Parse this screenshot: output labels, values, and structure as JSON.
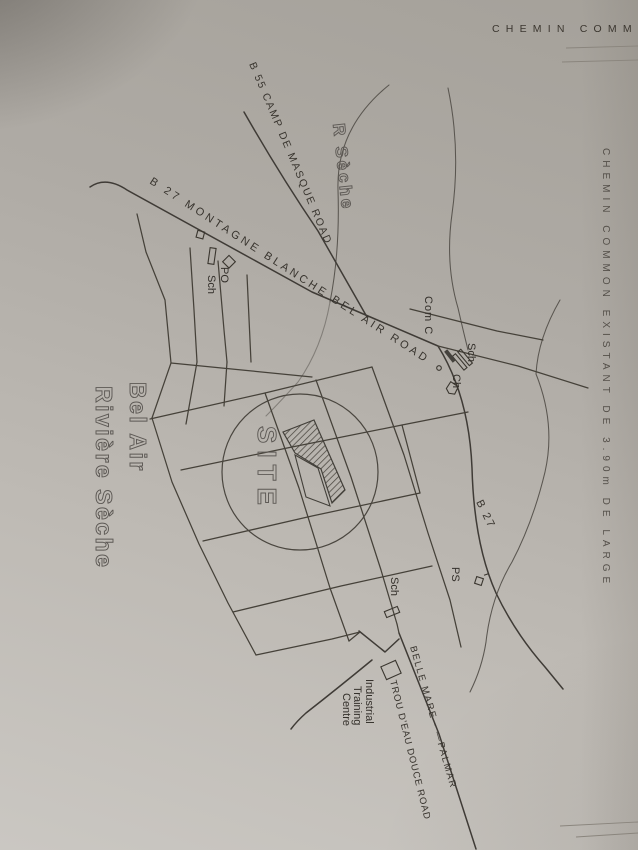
{
  "sheet": {
    "top_note": "CHEMIN COMM",
    "side_note": "CHEMIN COMMON EXISTANT DE 3.90m DE LARGE",
    "colors": {
      "paper": "#b2aea8",
      "ink": "#3f3b36",
      "outline_text": "#5d5955"
    }
  },
  "map": {
    "road_labels": {
      "b55": "B 55 CAMP DE MASQUE ROAD",
      "b27_full": "B 27 MONTAGNE BLANCHE BEL AIR ROAD",
      "b27_short": "B 27",
      "belle_mare_palmar": "BELLE MARE - —PALMAR",
      "trou_deau_douce": "TROU D'EAU DOUCE ROAD"
    },
    "place_labels": {
      "river": "R Sèche",
      "village_line1": "Bel Air",
      "village_line2": "Rivière Sèche",
      "site": "SITE",
      "post_office": "PO",
      "school_west": "Sch",
      "community_centre": "Com C",
      "school_east": "Sch",
      "church": "Ch",
      "police_station": "PS",
      "school_south": "Sch",
      "itc_line1": "Industrial",
      "itc_line2": "Training",
      "itc_line3": "Centre"
    }
  }
}
